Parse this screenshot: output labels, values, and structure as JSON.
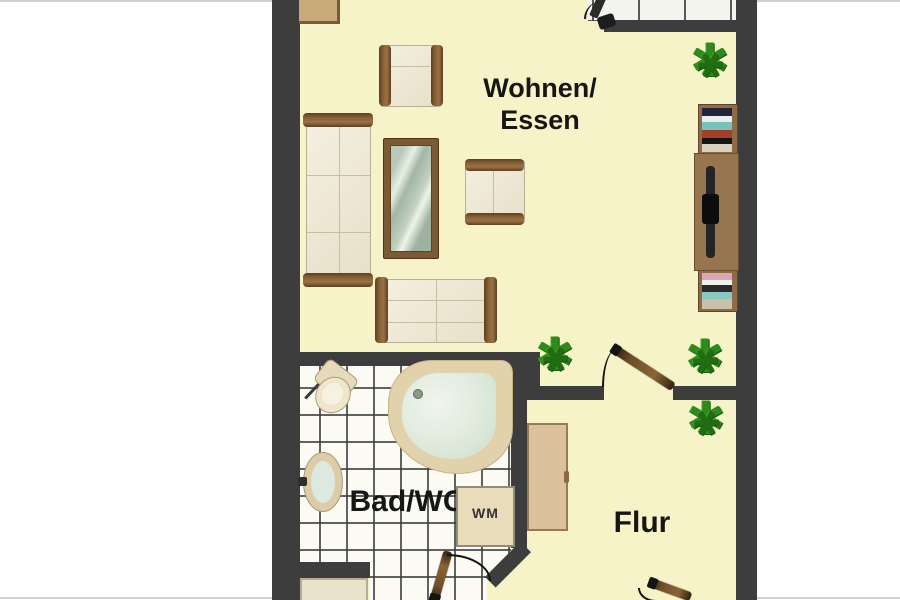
{
  "rooms": {
    "living": {
      "line1": "Wohnen/",
      "line2": "Essen"
    },
    "bath": {
      "label": "Bad/WC"
    },
    "hall": {
      "label": "Flur"
    }
  },
  "appliances": {
    "washing_machine": "WM"
  },
  "icons": {
    "plant": "✱"
  },
  "colors": {
    "floor": "#f6f3c8",
    "wall": "#3d3d3d",
    "tile_bg": "#fbfbf4",
    "wood": "#7b5a36",
    "cream": "#efe8d3",
    "plant": "#2e8a1b",
    "tub_rim": "#e2d2ac",
    "tub_water": "#dbe8da",
    "wardrobe": "#dcc19d",
    "wm_box": "#e9dcba"
  }
}
